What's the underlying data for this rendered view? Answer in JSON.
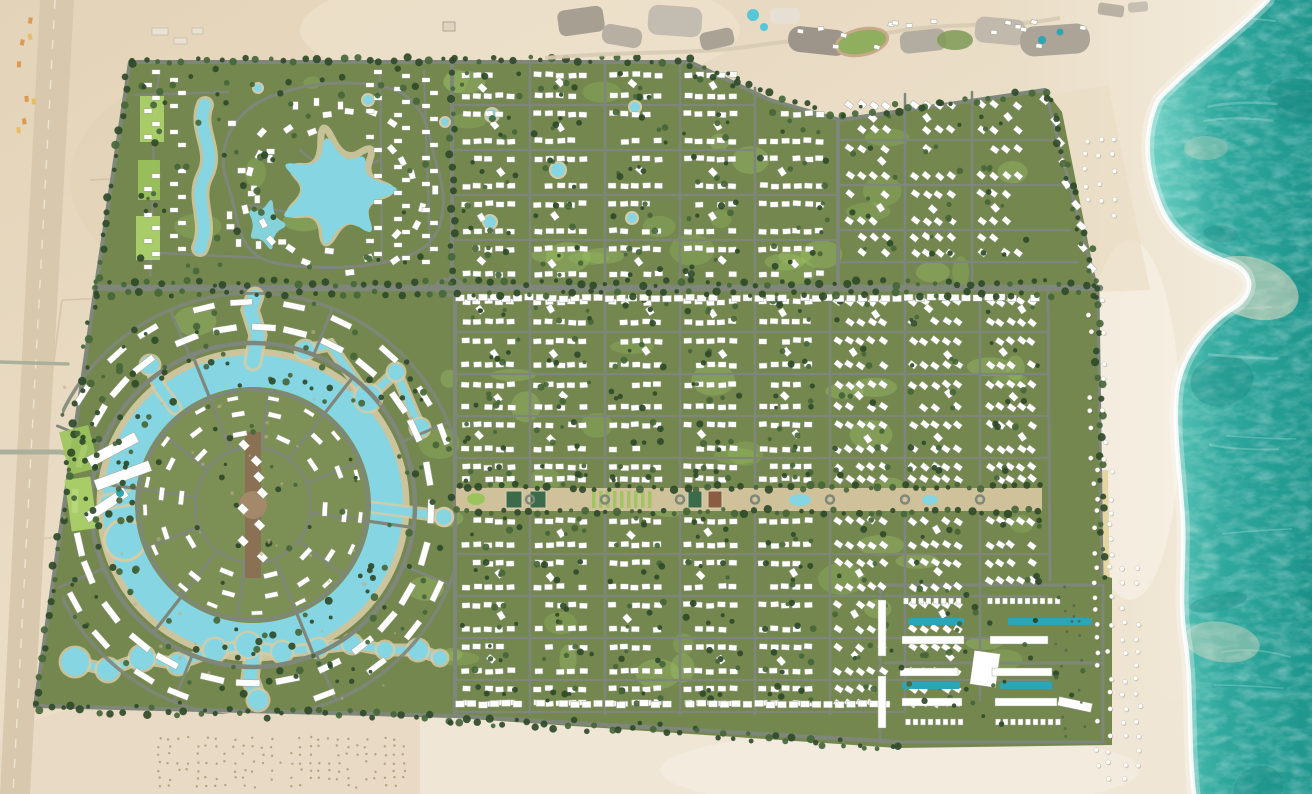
{
  "map": {
    "kind": "aerial-master-plan-render",
    "aria_label": "Aerial master plan rendering of a beachfront resort community with lagoons, villa grids and sea",
    "palette": {
      "desertA": "#ece0ca",
      "desertB": "#ddccb0",
      "desertPink": "#e9d8c2",
      "beachA": "#f4ecdd",
      "beachB": "#e9ddc6",
      "sandGold": "#e0d199",
      "green": "#74874f",
      "greenLight": "#7c8f55",
      "lawn": "#9cc45c",
      "lawnBright": "#aed46a",
      "tree": "#2f4a29",
      "tree2": "#47663a",
      "road": "#7f877a",
      "roadLight": "#aab09b",
      "lagoon": "#85d6e2",
      "lagoonRim": "#d6cba4",
      "pool": "#2da5b2",
      "seaA": "#66cdc0",
      "seaB": "#1e968d",
      "seaDeep": "#15857e",
      "seaLight": "#9fe2d6",
      "building": "#ffffff",
      "bldStroke": "#9aa08f",
      "plaza": "#8a7154",
      "plazaLight": "#a3886a",
      "parkband": "#cfc29b",
      "court": "#3c6b4b",
      "gray1": "#a79f91",
      "gray2": "#c0b9ac",
      "resortGreen": "#8fae5e",
      "trackRim": "#caa98a",
      "orchard": "#a8936f",
      "hwBand": "#d8c9ae",
      "hwDash": "#f0e7d5",
      "parcel": "#c6b69a",
      "cabYellow": "#e7bb5e",
      "cabOrange": "#dd9448"
    },
    "regions": [
      {
        "id": "sea",
        "label": "sea"
      },
      {
        "id": "shoreline-surf",
        "label": "shoreline surf"
      },
      {
        "id": "beach",
        "label": "beach"
      },
      {
        "id": "beach-umbrella-rows",
        "label": "beach umbrella rows"
      },
      {
        "id": "desert-hinterland",
        "label": "desert hinterland"
      },
      {
        "id": "coastal-highway",
        "label": "coastal highway"
      },
      {
        "id": "existing-resort-strip",
        "label": "existing resort strip"
      },
      {
        "id": "north-lagoon-community",
        "label": "north lagoon community"
      },
      {
        "id": "north-villa-grid",
        "label": "north villa grid"
      },
      {
        "id": "main-cross-road",
        "label": "main cross road"
      },
      {
        "id": "lagoon-ring-district",
        "label": "lagoon ring district"
      },
      {
        "id": "central-island-town",
        "label": "central island town"
      },
      {
        "id": "south-villa-grid",
        "label": "south villa grid"
      },
      {
        "id": "central-linear-park",
        "label": "central linear park"
      },
      {
        "id": "beachfront-apartment-complex",
        "label": "beachfront apartment complex"
      },
      {
        "id": "west-hotel-parcel",
        "label": "west hotel parcel"
      },
      {
        "id": "boundary-tree-belt",
        "label": "boundary tree belt"
      }
    ]
  }
}
